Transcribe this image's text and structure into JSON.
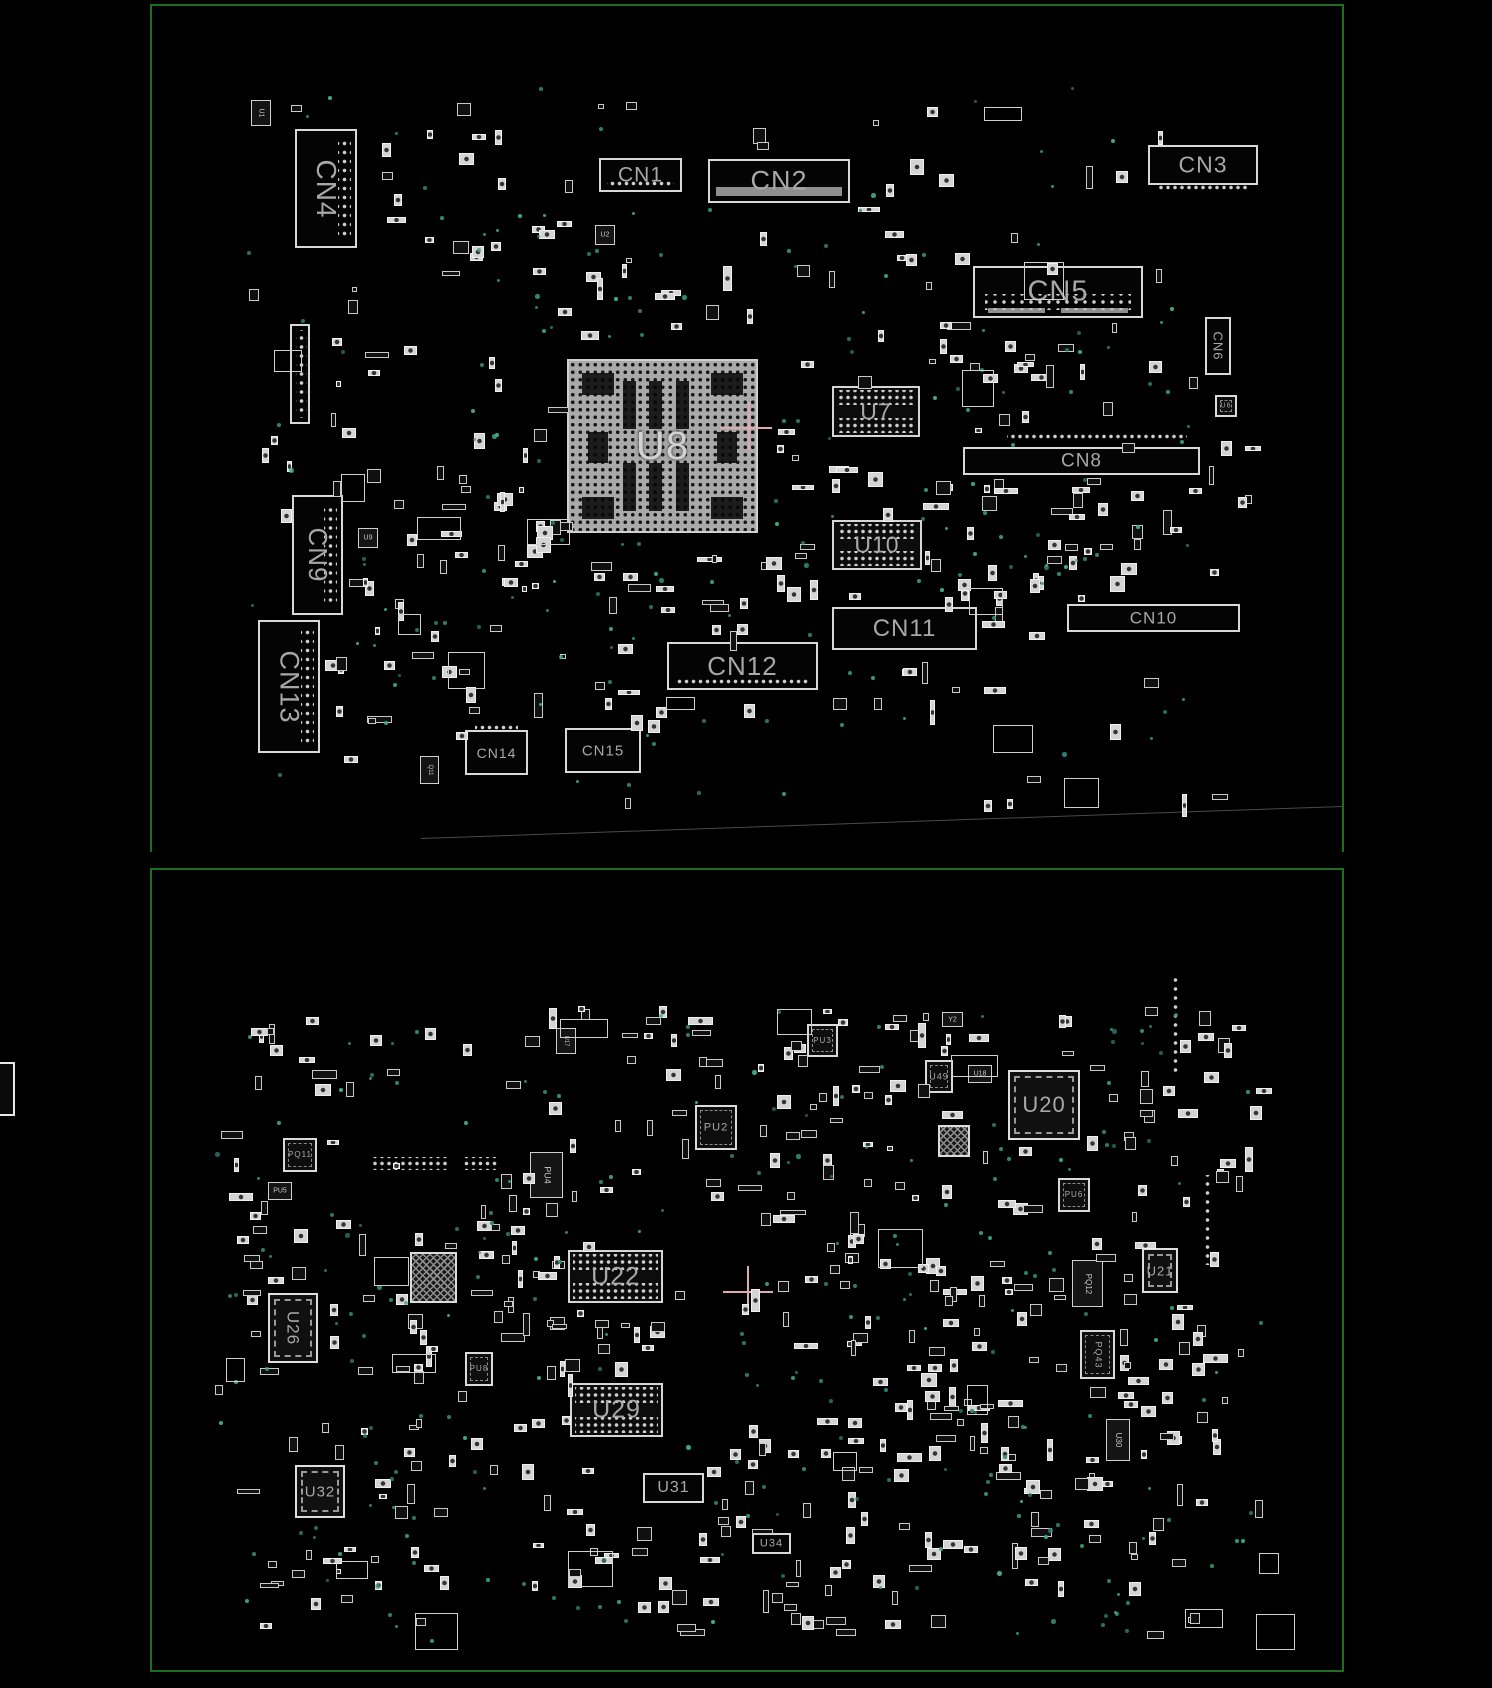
{
  "colors": {
    "background": "#000000",
    "board_outline": "#1e6e22",
    "component_outline": "#d8d8d8",
    "label": "#a8a8a8",
    "via": "#2f8a78",
    "crosshair": "#dcaab2",
    "bga_fill": "#a9a9a9"
  },
  "top_board": {
    "name": "top-view",
    "components": [
      {
        "label": "U1",
        "x": 251,
        "y": 100,
        "w": 20,
        "h": 26,
        "type": "chip",
        "rot": true,
        "fs": 7
      },
      {
        "label": "CN4",
        "x": 295,
        "y": 129,
        "w": 62,
        "h": 119,
        "type": "connector",
        "rot": true,
        "fs": 28,
        "pads": "right"
      },
      {
        "label": "CN1",
        "x": 599,
        "y": 158,
        "w": 83,
        "h": 34,
        "type": "connector",
        "fs": 21,
        "pads": "bottom-in"
      },
      {
        "label": "CN2",
        "x": 708,
        "y": 159,
        "w": 142,
        "h": 44,
        "type": "connector",
        "fs": 27,
        "bar": true
      },
      {
        "label": "U2",
        "x": 595,
        "y": 225,
        "w": 20,
        "h": 20,
        "type": "chip",
        "fs": 7
      },
      {
        "label": "CN3",
        "x": 1148,
        "y": 145,
        "w": 110,
        "h": 40,
        "type": "connector",
        "fs": 23,
        "pads": "below"
      },
      {
        "label": "CN5",
        "x": 973,
        "y": 266,
        "w": 170,
        "h": 52,
        "type": "connector",
        "fs": 29,
        "pads": "rows2"
      },
      {
        "label": "CN6",
        "x": 1205,
        "y": 317,
        "w": 26,
        "h": 58,
        "type": "connector",
        "rot": true,
        "fs": 13
      },
      {
        "label": "",
        "x": 290,
        "y": 324,
        "w": 20,
        "h": 100,
        "type": "connector",
        "pads": "col"
      },
      {
        "label": "U8",
        "x": 567,
        "y": 359,
        "w": 191,
        "h": 174,
        "type": "bga-big",
        "fs": 40
      },
      {
        "label": "U7",
        "x": 832,
        "y": 386,
        "w": 88,
        "h": 51,
        "type": "bga",
        "fs": 23
      },
      {
        "label": "CN8",
        "x": 963,
        "y": 447,
        "w": 237,
        "h": 28,
        "type": "connector",
        "fs": 19
      },
      {
        "label": "U6",
        "x": 1215,
        "y": 395,
        "w": 22,
        "h": 22,
        "type": "qfn",
        "fs": 7
      },
      {
        "label": "U10",
        "x": 832,
        "y": 520,
        "w": 90,
        "h": 50,
        "type": "bga",
        "fs": 23
      },
      {
        "label": "CN9",
        "x": 292,
        "y": 495,
        "w": 51,
        "h": 120,
        "type": "connector",
        "rot": true,
        "fs": 26,
        "pads": "right"
      },
      {
        "label": "U9",
        "x": 358,
        "y": 528,
        "w": 20,
        "h": 20,
        "type": "chip",
        "fs": 7
      },
      {
        "label": "CN10",
        "x": 1067,
        "y": 604,
        "w": 173,
        "h": 28,
        "type": "connector",
        "fs": 17
      },
      {
        "label": "CN11",
        "x": 832,
        "y": 607,
        "w": 145,
        "h": 43,
        "type": "connector",
        "fs": 24
      },
      {
        "label": "CN13",
        "x": 258,
        "y": 620,
        "w": 62,
        "h": 133,
        "type": "connector",
        "rot": true,
        "fs": 27,
        "pads": "right"
      },
      {
        "label": "CN12",
        "x": 667,
        "y": 642,
        "w": 151,
        "h": 48,
        "type": "connector",
        "fs": 26,
        "pads": "bottom-in"
      },
      {
        "label": "CN14",
        "x": 465,
        "y": 730,
        "w": 63,
        "h": 45,
        "type": "connector",
        "fs": 14,
        "pads": "top-out"
      },
      {
        "label": "CN15",
        "x": 565,
        "y": 728,
        "w": 76,
        "h": 45,
        "type": "connector",
        "fs": 15
      },
      {
        "label": "Q11",
        "x": 420,
        "y": 756,
        "w": 19,
        "h": 28,
        "type": "chip",
        "rot": true,
        "fs": 6
      }
    ]
  },
  "bottom_board": {
    "name": "bottom-view",
    "components": [
      {
        "label": "U17",
        "x": 556,
        "y": 1028,
        "w": 20,
        "h": 26,
        "type": "chip",
        "rot": true,
        "fs": 6
      },
      {
        "label": "PU3",
        "x": 807,
        "y": 1024,
        "w": 31,
        "h": 33,
        "type": "qfn",
        "fs": 8
      },
      {
        "label": "Y2",
        "x": 942,
        "y": 1012,
        "w": 21,
        "h": 15,
        "type": "chip",
        "fs": 7
      },
      {
        "label": "U49",
        "x": 925,
        "y": 1060,
        "w": 28,
        "h": 33,
        "type": "qfn",
        "fs": 9
      },
      {
        "label": "U18",
        "x": 968,
        "y": 1065,
        "w": 24,
        "h": 18,
        "type": "chip",
        "fs": 7
      },
      {
        "label": "U20",
        "x": 1008,
        "y": 1070,
        "w": 72,
        "h": 70,
        "type": "qfn-large",
        "fs": 22
      },
      {
        "label": "PU2",
        "x": 695,
        "y": 1105,
        "w": 42,
        "h": 45,
        "type": "qfn",
        "fs": 11
      },
      {
        "label": "",
        "x": 938,
        "y": 1125,
        "w": 32,
        "h": 32,
        "type": "qfn-hatch"
      },
      {
        "label": "PQ11",
        "x": 283,
        "y": 1138,
        "w": 34,
        "h": 34,
        "type": "qfn",
        "fs": 8
      },
      {
        "label": "PU4",
        "x": 530,
        "y": 1152,
        "w": 33,
        "h": 46,
        "type": "chip",
        "rot": true,
        "fs": 9
      },
      {
        "label": "PU5",
        "x": 268,
        "y": 1182,
        "w": 24,
        "h": 18,
        "type": "chip",
        "fs": 7
      },
      {
        "label": "PU6",
        "x": 1058,
        "y": 1178,
        "w": 32,
        "h": 34,
        "type": "qfn",
        "fs": 8
      },
      {
        "label": "U22",
        "x": 568,
        "y": 1250,
        "w": 95,
        "h": 53,
        "type": "bga",
        "fs": 25
      },
      {
        "label": "",
        "x": 410,
        "y": 1252,
        "w": 47,
        "h": 51,
        "type": "qfn-hatch"
      },
      {
        "label": "PQ12",
        "x": 1072,
        "y": 1260,
        "w": 31,
        "h": 47,
        "type": "chip",
        "rot": true,
        "fs": 8
      },
      {
        "label": "U21",
        "x": 1142,
        "y": 1248,
        "w": 36,
        "h": 45,
        "type": "qfn-large",
        "fs": 13
      },
      {
        "label": "U26",
        "x": 268,
        "y": 1293,
        "w": 50,
        "h": 70,
        "type": "qfn-large",
        "rot": true,
        "fs": 17
      },
      {
        "label": "PQ43",
        "x": 1080,
        "y": 1330,
        "w": 35,
        "h": 49,
        "type": "qfn",
        "rot": true,
        "fs": 9
      },
      {
        "label": "PU8",
        "x": 465,
        "y": 1352,
        "w": 28,
        "h": 34,
        "type": "qfn",
        "fs": 8
      },
      {
        "label": "U29",
        "x": 570,
        "y": 1383,
        "w": 93,
        "h": 54,
        "type": "bga",
        "fs": 25
      },
      {
        "label": "U30",
        "x": 1106,
        "y": 1419,
        "w": 24,
        "h": 42,
        "type": "chip",
        "rot": true,
        "fs": 8
      },
      {
        "label": "U32",
        "x": 295,
        "y": 1465,
        "w": 50,
        "h": 53,
        "type": "qfn-large",
        "fs": 15
      },
      {
        "label": "U31",
        "x": 643,
        "y": 1473,
        "w": 61,
        "h": 30,
        "type": "connector",
        "fs": 16
      },
      {
        "label": "U34",
        "x": 752,
        "y": 1533,
        "w": 39,
        "h": 21,
        "type": "connector",
        "fs": 11
      }
    ]
  },
  "pad_strips": [
    {
      "x": 1007,
      "y": 432,
      "w": 180,
      "h": 9,
      "o": "h"
    },
    {
      "x": 370,
      "y": 1157,
      "w": 80,
      "h": 13,
      "o": "h"
    },
    {
      "x": 463,
      "y": 1157,
      "w": 35,
      "h": 13,
      "o": "h"
    },
    {
      "x": 1203,
      "y": 1175,
      "w": 9,
      "h": 90,
      "o": "v"
    },
    {
      "x": 1171,
      "y": 975,
      "w": 9,
      "h": 100,
      "o": "v"
    }
  ],
  "crosshairs": [
    {
      "x": 748,
      "y": 427,
      "h1": 720,
      "h2": 772,
      "v1": 402,
      "v2": 450
    },
    {
      "x": 747,
      "y": 1291,
      "h1": 723,
      "h2": 773,
      "v1": 1266,
      "v2": 1313
    }
  ]
}
